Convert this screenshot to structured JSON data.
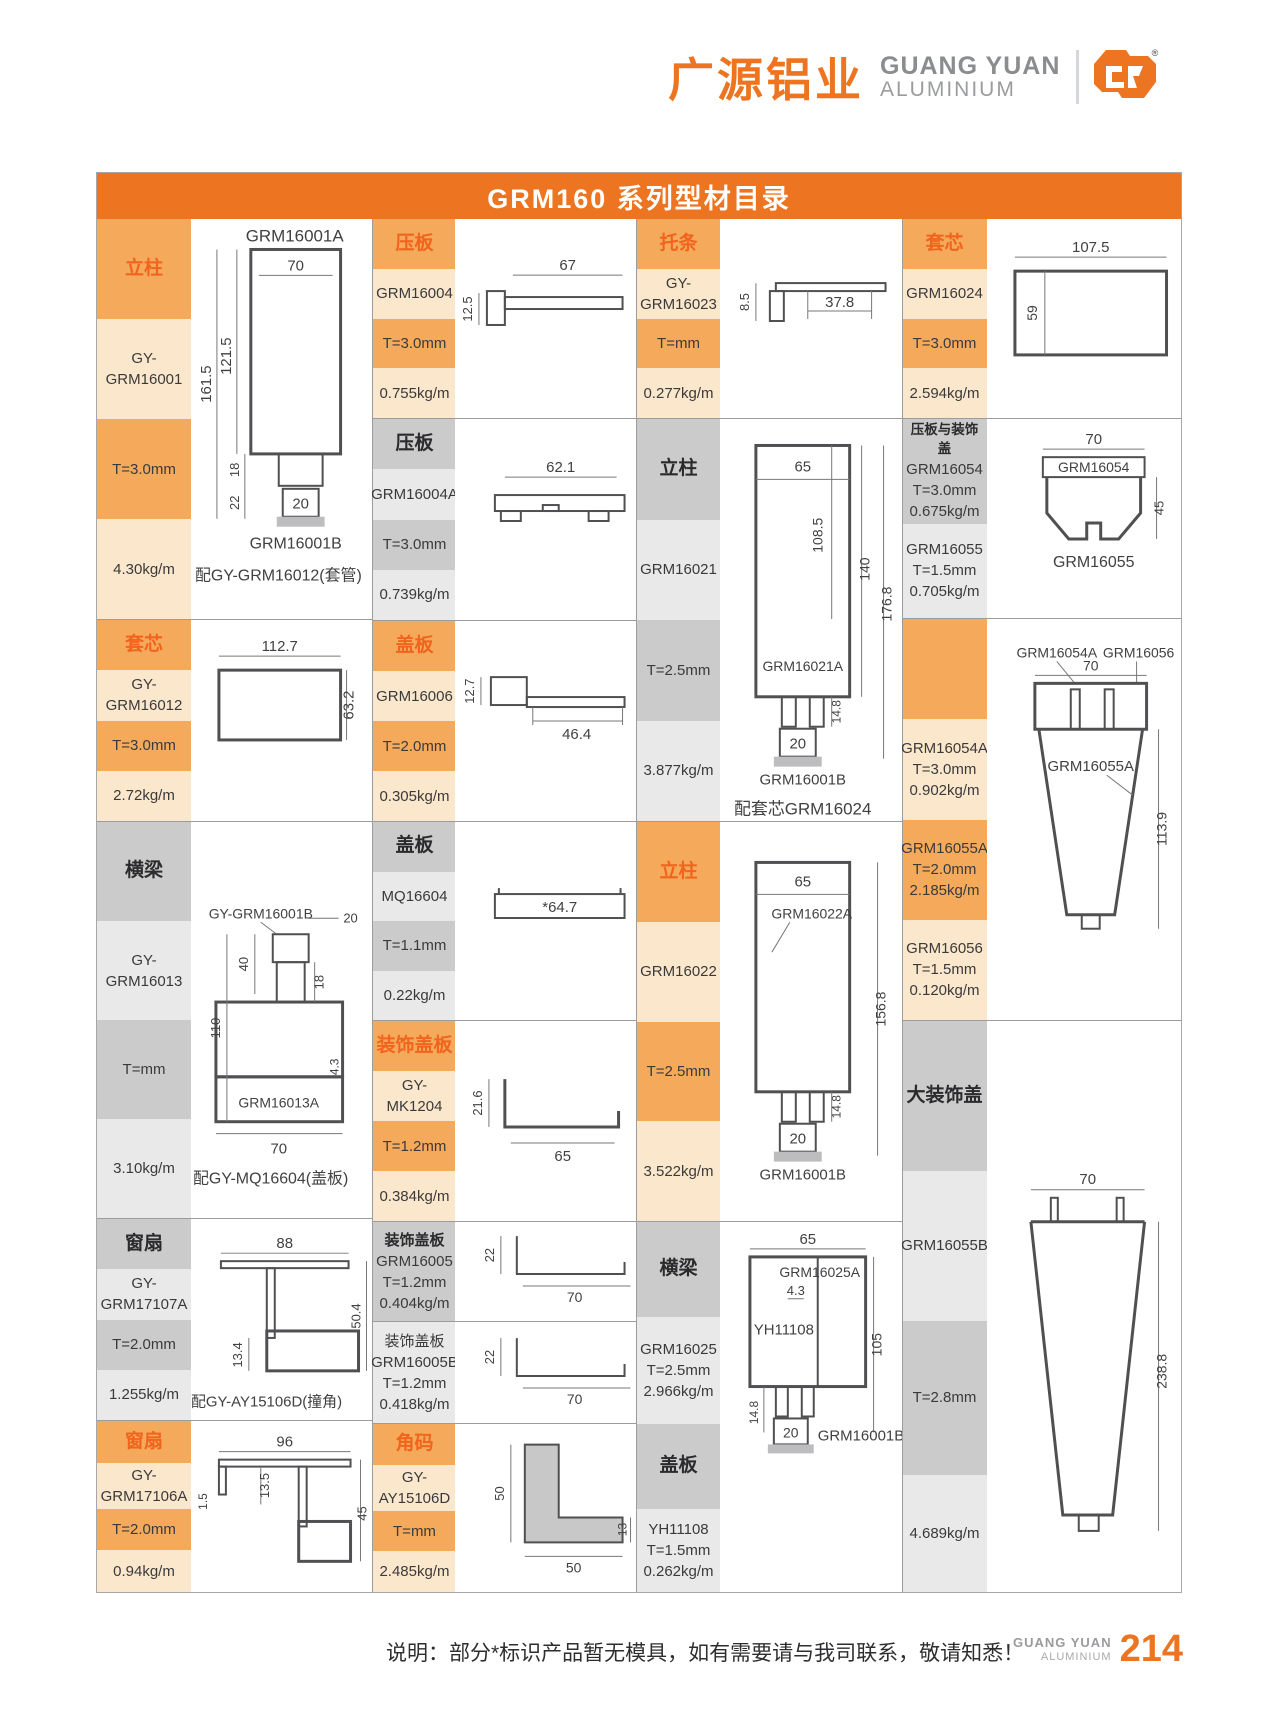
{
  "header": {
    "brand_cn": "广源铝业",
    "brand_en": "GUANG YUAN",
    "brand_en_sub": "ALUMINIUM",
    "reg": "®"
  },
  "title": "GRM160 系列型材目录",
  "footer": {
    "note": "说明：部分*标识产品暂无模具，如有需要请与我司联系，敬请知悉！",
    "brand_en": "GUANG YUAN",
    "brand_en_sub": "ALUMINIUM",
    "page": "214"
  },
  "colors": {
    "accent_orange": "#ED7420",
    "header_text_orange": "#F1641E",
    "cell_dark_orange": "#F4AA5A",
    "cell_light_orange": "#FBE7CB",
    "cell_dark_gray": "#CBCBCB",
    "cell_light_gray": "#E9E9E9"
  },
  "groups": [
    {
      "name": "col-1",
      "sections": [
        {
          "id": "lizhu-16001",
          "theme": "orange",
          "cells": [
            {
              "lines": [
                "立柱"
              ]
            },
            {
              "lines": [
                "GY-GRM16001"
              ]
            },
            {
              "lines": [
                "T=3.0mm"
              ]
            },
            {
              "lines": [
                "4.30kg/m"
              ]
            }
          ],
          "drawing": {
            "texts": [
              "GRM16001A",
              "70",
              "121.5",
              "161.5",
              "18",
              "22",
              "20",
              "GRM16001B",
              "配GY-GRM16012(套管)"
            ]
          }
        },
        {
          "id": "taoxin-16012",
          "theme": "orange",
          "cells": [
            {
              "lines": [
                "套芯"
              ]
            },
            {
              "lines": [
                "GY-GRM16012"
              ]
            },
            {
              "lines": [
                "T=3.0mm"
              ]
            },
            {
              "lines": [
                "2.72kg/m"
              ]
            }
          ],
          "drawing": {
            "texts": [
              "112.7",
              "63.2"
            ]
          }
        },
        {
          "id": "hengliang-16013",
          "theme": "gray",
          "cells": [
            {
              "lines": [
                "横梁"
              ]
            },
            {
              "lines": [
                "GY-GRM16013"
              ]
            },
            {
              "lines": [
                "T=mm"
              ]
            },
            {
              "lines": [
                "3.10kg/m"
              ]
            }
          ],
          "drawing": {
            "texts": [
              "GY-GRM16001B",
              "20",
              "40",
              "18",
              "110",
              "4.3",
              "GRM16013A",
              "70",
              "配GY-MQ16604(盖板)"
            ]
          }
        },
        {
          "id": "chuangshan-17107A",
          "theme": "gray",
          "cells": [
            {
              "lines": [
                "窗扇"
              ]
            },
            {
              "lines": [
                "GY-GRM17107A"
              ]
            },
            {
              "lines": [
                "T=2.0mm"
              ]
            },
            {
              "lines": [
                "1.255kg/m"
              ]
            }
          ],
          "drawing": {
            "texts": [
              "88",
              "13.4",
              "50.4",
              "配GY-AY15106D(撞角)"
            ]
          }
        },
        {
          "id": "chuangshan-17106A",
          "theme": "orange",
          "cells": [
            {
              "lines": [
                "窗扇"
              ]
            },
            {
              "lines": [
                "GY-GRM17106A"
              ]
            },
            {
              "lines": [
                "T=2.0mm"
              ]
            },
            {
              "lines": [
                "0.94kg/m"
              ]
            }
          ],
          "drawing": {
            "texts": [
              "96",
              "13.5",
              "1.5",
              "45"
            ]
          }
        }
      ]
    },
    {
      "name": "col-2",
      "sections": [
        {
          "id": "yaban-16004",
          "theme": "orange",
          "cells": [
            {
              "lines": [
                "压板"
              ]
            },
            {
              "lines": [
                "GRM16004"
              ]
            },
            {
              "lines": [
                "T=3.0mm"
              ]
            },
            {
              "lines": [
                "0.755kg/m"
              ]
            }
          ],
          "drawing": {
            "texts": [
              "67",
              "12.5"
            ]
          }
        },
        {
          "id": "yaban-16004A",
          "theme": "gray",
          "cells": [
            {
              "lines": [
                "压板"
              ]
            },
            {
              "lines": [
                "GRM16004A"
              ]
            },
            {
              "lines": [
                "T=3.0mm"
              ]
            },
            {
              "lines": [
                "0.739kg/m"
              ]
            }
          ],
          "drawing": {
            "texts": [
              "62.1"
            ]
          }
        },
        {
          "id": "gaiban-16006",
          "theme": "orange",
          "cells": [
            {
              "lines": [
                "盖板"
              ]
            },
            {
              "lines": [
                "GRM16006"
              ]
            },
            {
              "lines": [
                "T=2.0mm"
              ]
            },
            {
              "lines": [
                "0.305kg/m"
              ]
            }
          ],
          "drawing": {
            "texts": [
              "12.7",
              "46.4"
            ]
          }
        },
        {
          "id": "gaiban-MQ16604",
          "theme": "gray",
          "cells": [
            {
              "lines": [
                "盖板"
              ]
            },
            {
              "lines": [
                "MQ16604"
              ]
            },
            {
              "lines": [
                "T=1.1mm"
              ]
            },
            {
              "lines": [
                "0.22kg/m"
              ]
            }
          ],
          "drawing": {
            "texts": [
              "*64.7"
            ]
          }
        },
        {
          "id": "zhuangshigaiban-MK1204",
          "theme": "orange",
          "cells": [
            {
              "lines": [
                "装饰盖板"
              ]
            },
            {
              "lines": [
                "GY-MK1204"
              ]
            },
            {
              "lines": [
                "T=1.2mm"
              ]
            },
            {
              "lines": [
                "0.384kg/m"
              ]
            }
          ],
          "drawing": {
            "texts": [
              "21.6",
              "65"
            ]
          }
        },
        {
          "id": "zhuangshigaiban-16005",
          "theme": "gray",
          "cells": [
            {
              "lines": [
                "装饰盖板",
                "GRM16005",
                "T=1.2mm",
                "0.404kg/m"
              ]
            }
          ],
          "drawing": {
            "texts": [
              "22",
              "70"
            ]
          }
        },
        {
          "id": "zhuangshigaiban-16005B",
          "theme": "gray",
          "cells": [
            {
              "lines": [
                "装饰盖板",
                "GRM16005B",
                "T=1.2mm",
                "0.418kg/m"
              ]
            }
          ],
          "drawing": {
            "texts": [
              "22",
              "70"
            ]
          }
        },
        {
          "id": "jiaoma-AY15106D",
          "theme": "orange",
          "cells": [
            {
              "lines": [
                "角码"
              ]
            },
            {
              "lines": [
                "GY-AY15106D"
              ]
            },
            {
              "lines": [
                "T=mm"
              ]
            },
            {
              "lines": [
                "2.485kg/m"
              ]
            }
          ],
          "drawing": {
            "texts": [
              "50",
              "50",
              "13"
            ]
          }
        }
      ]
    },
    {
      "name": "col-3",
      "sections": [
        {
          "id": "tuotiao-16023",
          "theme": "orange",
          "cells": [
            {
              "lines": [
                "托条"
              ]
            },
            {
              "lines": [
                "GY-GRM16023"
              ]
            },
            {
              "lines": [
                "T=mm"
              ]
            },
            {
              "lines": [
                "0.277kg/m"
              ]
            }
          ],
          "drawing": {
            "texts": [
              "8.5",
              "37.8"
            ]
          }
        },
        {
          "id": "lizhu-16021",
          "theme": "gray",
          "cells": [
            {
              "lines": [
                "立柱"
              ]
            },
            {
              "lines": [
                "GRM16021"
              ]
            },
            {
              "lines": [
                "T=2.5mm"
              ]
            },
            {
              "lines": [
                "3.877kg/m"
              ]
            }
          ],
          "drawing": {
            "texts": [
              "65",
              "108.5",
              "140",
              "176.8",
              "GRM16021A",
              "14.8",
              "20",
              "GRM16001B",
              "配套芯GRM16024"
            ]
          }
        },
        {
          "id": "lizhu-16022",
          "theme": "orange",
          "cells": [
            {
              "lines": [
                "立柱"
              ]
            },
            {
              "lines": [
                "GRM16022"
              ]
            },
            {
              "lines": [
                "T=2.5mm"
              ]
            },
            {
              "lines": [
                "3.522kg/m"
              ]
            }
          ],
          "drawing": {
            "texts": [
              "65",
              "GRM16022A",
              "156.8",
              "14.8",
              "20",
              "GRM16001B"
            ]
          }
        },
        {
          "id": "hengliang-16025",
          "theme": "gray",
          "cells": [
            {
              "lines": [
                "横梁"
              ]
            },
            {
              "lines": [
                "GRM16025",
                "T=2.5mm",
                "2.966kg/m"
              ]
            },
            {
              "lines": [
                "盖板"
              ]
            },
            {
              "lines": [
                "YH11108",
                "T=1.5mm",
                "0.262kg/m"
              ]
            }
          ],
          "drawing": {
            "texts": [
              "65",
              "GRM16025A",
              "4.3",
              "YH11108",
              "105",
              "14.8",
              "20",
              "GRM16001B"
            ]
          }
        }
      ]
    },
    {
      "name": "col-4",
      "sections": [
        {
          "id": "taoxin-16024",
          "theme": "orange",
          "cells": [
            {
              "lines": [
                "套芯"
              ]
            },
            {
              "lines": [
                "GRM16024"
              ]
            },
            {
              "lines": [
                "T=3.0mm"
              ]
            },
            {
              "lines": [
                "2.594kg/m"
              ]
            }
          ],
          "drawing": {
            "texts": [
              "107.5",
              "59"
            ]
          }
        },
        {
          "id": "yaban-zhuangshigai",
          "theme": "gray",
          "cells": [
            {
              "lines": [
                "压板与装饰盖",
                "GRM16054",
                "T=3.0mm",
                "0.675kg/m"
              ]
            },
            {
              "lines": [
                "GRM16055",
                "T=1.5mm",
                "0.705kg/m"
              ]
            }
          ],
          "drawing": {
            "texts": [
              "70",
              "GRM16054",
              "45",
              "GRM16055"
            ]
          }
        },
        {
          "id": "grm16054A-56",
          "theme": "orange",
          "cells": [
            {
              "lines": []
            },
            {
              "lines": [
                "GRM16054A",
                "T=3.0mm",
                "0.902kg/m"
              ]
            },
            {
              "lines": [
                "GRM16055A",
                "T=2.0mm",
                "2.185kg/m"
              ]
            },
            {
              "lines": [
                "GRM16056",
                "T=1.5mm",
                "0.120kg/m"
              ]
            }
          ],
          "drawing": {
            "texts": [
              "GRM16054A",
              "GRM16056",
              "70",
              "GRM16055A",
              "113.9"
            ]
          }
        },
        {
          "id": "dazhuangshigai-16055B",
          "theme": "gray",
          "cells": [
            {
              "lines": [
                "大装饰盖"
              ]
            },
            {
              "lines": [
                "GRM16055B"
              ]
            },
            {
              "lines": [
                "T=2.8mm"
              ]
            },
            {
              "lines": [
                "4.689kg/m"
              ]
            }
          ],
          "drawing": {
            "texts": [
              "70",
              "238.8"
            ]
          }
        }
      ]
    }
  ]
}
